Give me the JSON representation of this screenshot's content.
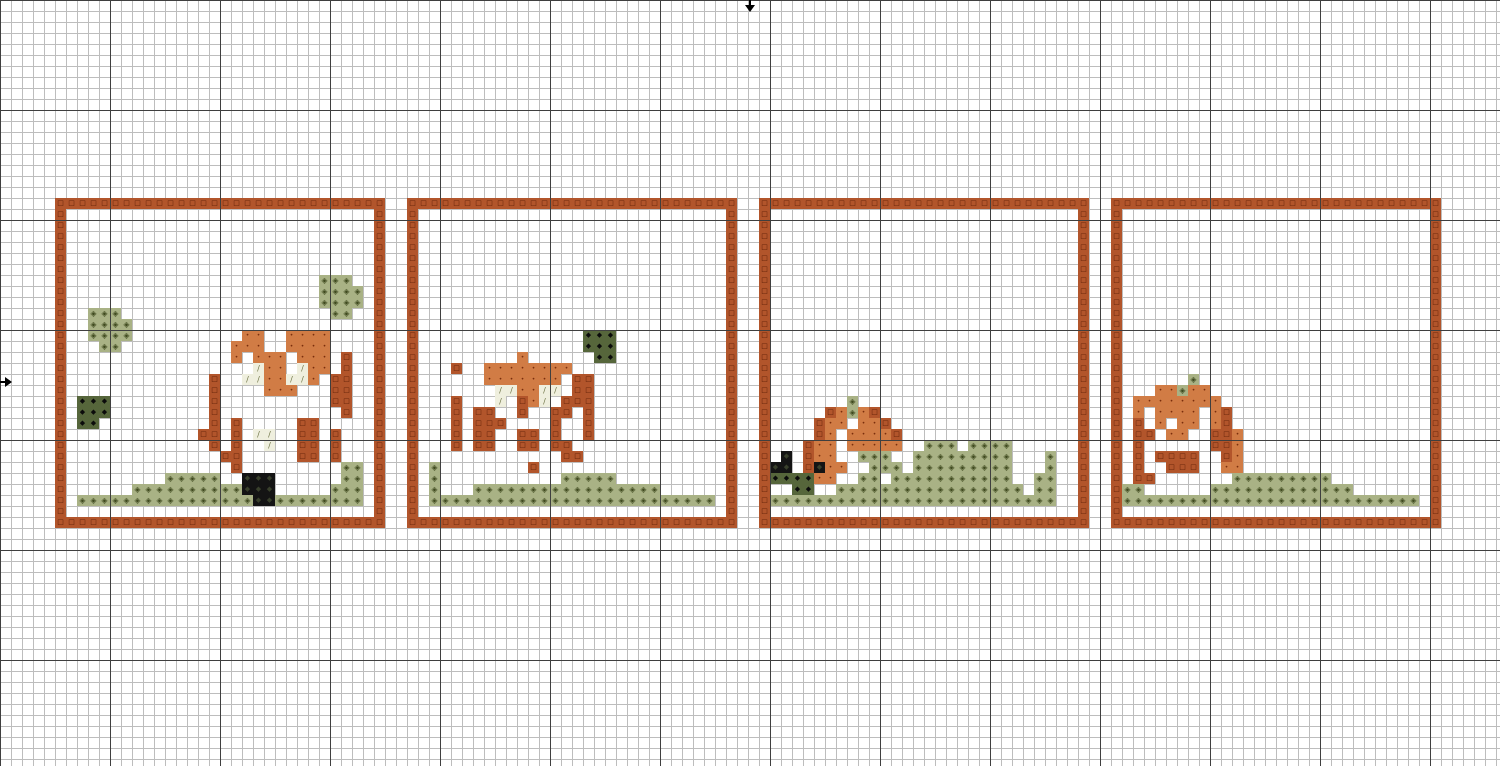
{
  "app": {
    "name": "cross-stitch pattern canvas"
  },
  "grid": {
    "cell_px": 11,
    "cols": 137,
    "rows": 70,
    "thick_every_cells": 10,
    "thin_line_color": "#bdbdbd",
    "thick_line_color": "#3f3f3f",
    "background_color": "#ffffff"
  },
  "markers": {
    "top_center_arrow": {
      "x": 750,
      "y": 0,
      "direction": "down",
      "color": "#000000"
    },
    "left_center_arrow": {
      "x": 0,
      "y": 382,
      "direction": "right",
      "color": "#000000"
    }
  },
  "palette": {
    "B": {
      "name": "dark-rust-outline",
      "bg": "#B2552B",
      "glyph": "□",
      "glyph_color": "#571B04",
      "glyph_px": 7
    },
    "O": {
      "name": "terracotta-body",
      "bg": "#D17C45",
      "glyph": "•",
      "glyph_color": "#7A2E0C",
      "glyph_px": 6
    },
    "C": {
      "name": "cream-highlight",
      "bg": "#EFEFDE",
      "glyph": "/",
      "glyph_color": "#6E7446",
      "glyph_px": 8
    },
    "G": {
      "name": "light-olive-grass",
      "bg": "#A9B285",
      "glyph": "◈",
      "glyph_color": "#3F4A1F",
      "glyph_px": 8
    },
    "D": {
      "name": "dark-olive-bush",
      "bg": "#56663B",
      "glyph": "◆",
      "glyph_color": "#0B0B0B",
      "glyph_px": 7
    },
    "K": {
      "name": "black-accent",
      "bg": "#141414",
      "glyph": "◆",
      "glyph_color": "#39402C",
      "glyph_px": 7
    }
  },
  "panels": [
    {
      "name": "panel-1-standing-fawn",
      "origin": {
        "col": 5,
        "row": 18
      },
      "size": {
        "cols": 30,
        "rows": 30
      },
      "frame_color": "B",
      "runs": [
        [
          "G",
          24,
          7,
          3
        ],
        [
          "G",
          24,
          8,
          4
        ],
        [
          "G",
          24,
          9,
          4
        ],
        [
          "G",
          25,
          10,
          2
        ],
        [
          "G",
          3,
          10,
          3
        ],
        [
          "G",
          3,
          11,
          4
        ],
        [
          "G",
          3,
          12,
          4
        ],
        [
          "G",
          4,
          13,
          2
        ],
        [
          "D",
          2,
          18,
          3
        ],
        [
          "D",
          2,
          19,
          3
        ],
        [
          "D",
          2,
          20,
          2
        ],
        [
          "O",
          17,
          12,
          2
        ],
        [
          "O",
          21,
          12,
          4
        ],
        [
          "O",
          16,
          13,
          3
        ],
        [
          "O",
          21,
          13,
          4
        ],
        [
          "O",
          16,
          14,
          1
        ],
        [
          "O",
          18,
          14,
          3
        ],
        [
          "O",
          22,
          14,
          3
        ],
        [
          "B",
          26,
          14,
          1
        ],
        [
          "C",
          18,
          15,
          1
        ],
        [
          "O",
          19,
          15,
          2
        ],
        [
          "C",
          22,
          15,
          1
        ],
        [
          "O",
          23,
          15,
          2
        ],
        [
          "B",
          26,
          15,
          1
        ],
        [
          "B",
          14,
          16,
          1
        ],
        [
          "C",
          17,
          16,
          2
        ],
        [
          "O",
          19,
          16,
          2
        ],
        [
          "C",
          21,
          16,
          2
        ],
        [
          "O",
          23,
          16,
          1
        ],
        [
          "B",
          25,
          16,
          2
        ],
        [
          "B",
          14,
          17,
          1
        ],
        [
          "O",
          19,
          17,
          3
        ],
        [
          "B",
          25,
          17,
          2
        ],
        [
          "B",
          14,
          18,
          1
        ],
        [
          "B",
          25,
          18,
          2
        ],
        [
          "B",
          14,
          19,
          1
        ],
        [
          "B",
          26,
          19,
          1
        ],
        [
          "B",
          14,
          20,
          1
        ],
        [
          "B",
          16,
          20,
          1
        ],
        [
          "B",
          22,
          20,
          2
        ],
        [
          "B",
          13,
          21,
          2
        ],
        [
          "B",
          16,
          21,
          1
        ],
        [
          "C",
          18,
          21,
          2
        ],
        [
          "B",
          22,
          21,
          2
        ],
        [
          "B",
          25,
          21,
          1
        ],
        [
          "B",
          14,
          22,
          1
        ],
        [
          "B",
          16,
          22,
          1
        ],
        [
          "C",
          19,
          22,
          1
        ],
        [
          "B",
          22,
          22,
          2
        ],
        [
          "B",
          25,
          22,
          1
        ],
        [
          "B",
          15,
          23,
          2
        ],
        [
          "B",
          22,
          23,
          2
        ],
        [
          "B",
          25,
          23,
          1
        ],
        [
          "B",
          16,
          24,
          1
        ],
        [
          "G",
          26,
          24,
          2
        ],
        [
          "G",
          10,
          25,
          5
        ],
        [
          "K",
          17,
          25,
          3
        ],
        [
          "G",
          26,
          25,
          2
        ],
        [
          "G",
          7,
          26,
          10
        ],
        [
          "K",
          17,
          26,
          3
        ],
        [
          "G",
          25,
          26,
          3
        ],
        [
          "G",
          2,
          27,
          16
        ],
        [
          "K",
          18,
          27,
          2
        ],
        [
          "G",
          20,
          27,
          8
        ]
      ]
    },
    {
      "name": "panel-2-grazing-deer",
      "origin": {
        "col": 37,
        "row": 18
      },
      "size": {
        "cols": 30,
        "rows": 30
      },
      "frame_color": "B",
      "runs": [
        [
          "D",
          16,
          12,
          3
        ],
        [
          "D",
          16,
          13,
          3
        ],
        [
          "D",
          17,
          14,
          2
        ],
        [
          "O",
          10,
          14,
          1
        ],
        [
          "B",
          4,
          15,
          1
        ],
        [
          "O",
          7,
          15,
          8
        ],
        [
          "O",
          7,
          16,
          7
        ],
        [
          "B",
          15,
          16,
          2
        ],
        [
          "C",
          8,
          17,
          2
        ],
        [
          "O",
          10,
          17,
          2
        ],
        [
          "C",
          12,
          17,
          2
        ],
        [
          "B",
          15,
          17,
          2
        ],
        [
          "B",
          4,
          18,
          1
        ],
        [
          "C",
          8,
          18,
          1
        ],
        [
          "B",
          10,
          18,
          1
        ],
        [
          "O",
          11,
          18,
          1
        ],
        [
          "C",
          12,
          18,
          1
        ],
        [
          "B",
          14,
          18,
          3
        ],
        [
          "B",
          4,
          19,
          1
        ],
        [
          "B",
          6,
          19,
          2
        ],
        [
          "B",
          10,
          19,
          1
        ],
        [
          "B",
          13,
          19,
          2
        ],
        [
          "B",
          16,
          19,
          1
        ],
        [
          "B",
          4,
          20,
          1
        ],
        [
          "B",
          6,
          20,
          2
        ],
        [
          "B",
          8,
          20,
          1
        ],
        [
          "B",
          13,
          20,
          1
        ],
        [
          "B",
          16,
          20,
          1
        ],
        [
          "B",
          4,
          21,
          1
        ],
        [
          "B",
          6,
          21,
          2
        ],
        [
          "B",
          10,
          21,
          2
        ],
        [
          "B",
          13,
          21,
          1
        ],
        [
          "B",
          16,
          21,
          1
        ],
        [
          "B",
          4,
          22,
          1
        ],
        [
          "B",
          6,
          22,
          2
        ],
        [
          "B",
          10,
          22,
          2
        ],
        [
          "B",
          13,
          22,
          2
        ],
        [
          "B",
          14,
          23,
          2
        ],
        [
          "B",
          11,
          24,
          1
        ],
        [
          "G",
          2,
          24,
          1
        ],
        [
          "G",
          2,
          25,
          1
        ],
        [
          "G",
          14,
          25,
          5
        ],
        [
          "G",
          2,
          26,
          1
        ],
        [
          "G",
          6,
          26,
          17
        ],
        [
          "G",
          2,
          27,
          26
        ]
      ]
    },
    {
      "name": "panel-3-squirrel-on-grass",
      "origin": {
        "col": 69,
        "row": 18
      },
      "size": {
        "cols": 30,
        "rows": 30
      },
      "frame_color": "B",
      "runs": [
        [
          "G",
          8,
          18,
          1
        ],
        [
          "B",
          6,
          19,
          1
        ],
        [
          "O",
          7,
          19,
          1
        ],
        [
          "G",
          8,
          19,
          1
        ],
        [
          "O",
          9,
          19,
          1
        ],
        [
          "B",
          10,
          19,
          1
        ],
        [
          "B",
          5,
          20,
          1
        ],
        [
          "O",
          6,
          20,
          2
        ],
        [
          "O",
          9,
          20,
          2
        ],
        [
          "B",
          11,
          20,
          1
        ],
        [
          "B",
          5,
          21,
          1
        ],
        [
          "O",
          6,
          21,
          1
        ],
        [
          "O",
          8,
          21,
          4
        ],
        [
          "B",
          12,
          21,
          1
        ],
        [
          "B",
          4,
          22,
          1
        ],
        [
          "O",
          5,
          22,
          2
        ],
        [
          "O",
          8,
          22,
          5
        ],
        [
          "G",
          15,
          22,
          3
        ],
        [
          "G",
          19,
          22,
          4
        ],
        [
          "K",
          2,
          23,
          1
        ],
        [
          "B",
          4,
          23,
          1
        ],
        [
          "O",
          5,
          23,
          2
        ],
        [
          "G",
          9,
          23,
          3
        ],
        [
          "G",
          14,
          23,
          9
        ],
        [
          "G",
          26,
          23,
          1
        ],
        [
          "K",
          1,
          24,
          2
        ],
        [
          "B",
          4,
          24,
          1
        ],
        [
          "K",
          5,
          24,
          1
        ],
        [
          "O",
          6,
          24,
          2
        ],
        [
          "G",
          10,
          24,
          3
        ],
        [
          "G",
          14,
          24,
          9
        ],
        [
          "G",
          26,
          24,
          1
        ],
        [
          "D",
          1,
          25,
          4
        ],
        [
          "O",
          5,
          25,
          2
        ],
        [
          "G",
          9,
          25,
          2
        ],
        [
          "G",
          12,
          25,
          11
        ],
        [
          "G",
          25,
          25,
          2
        ],
        [
          "D",
          3,
          26,
          2
        ],
        [
          "G",
          7,
          26,
          17
        ],
        [
          "G",
          25,
          26,
          2
        ],
        [
          "G",
          1,
          27,
          26
        ]
      ]
    },
    {
      "name": "panel-4-curled-sleeping-fawn",
      "origin": {
        "col": 101,
        "row": 18
      },
      "size": {
        "cols": 30,
        "rows": 30
      },
      "frame_color": "B",
      "runs": [
        [
          "G",
          7,
          16,
          1
        ],
        [
          "O",
          4,
          17,
          2
        ],
        [
          "G",
          6,
          17,
          1
        ],
        [
          "O",
          7,
          17,
          2
        ],
        [
          "O",
          2,
          18,
          8
        ],
        [
          "O",
          2,
          19,
          1
        ],
        [
          "O",
          4,
          19,
          4
        ],
        [
          "O",
          9,
          19,
          1
        ],
        [
          "B",
          10,
          19,
          1
        ],
        [
          "B",
          2,
          20,
          1
        ],
        [
          "O",
          4,
          20,
          1
        ],
        [
          "O",
          6,
          20,
          2
        ],
        [
          "O",
          9,
          20,
          1
        ],
        [
          "B",
          10,
          20,
          1
        ],
        [
          "B",
          2,
          21,
          2
        ],
        [
          "O",
          5,
          21,
          2
        ],
        [
          "B",
          9,
          21,
          2
        ],
        [
          "O",
          11,
          21,
          1
        ],
        [
          "B",
          2,
          22,
          1
        ],
        [
          "B",
          9,
          22,
          2
        ],
        [
          "O",
          11,
          22,
          1
        ],
        [
          "B",
          2,
          23,
          1
        ],
        [
          "B",
          4,
          23,
          4
        ],
        [
          "B",
          10,
          23,
          1
        ],
        [
          "O",
          11,
          23,
          1
        ],
        [
          "B",
          2,
          24,
          1
        ],
        [
          "B",
          5,
          24,
          3
        ],
        [
          "O",
          10,
          24,
          2
        ],
        [
          "B",
          2,
          25,
          2
        ],
        [
          "G",
          11,
          25,
          9
        ],
        [
          "G",
          1,
          26,
          2
        ],
        [
          "G",
          9,
          26,
          13
        ],
        [
          "G",
          1,
          27,
          27
        ]
      ]
    }
  ]
}
